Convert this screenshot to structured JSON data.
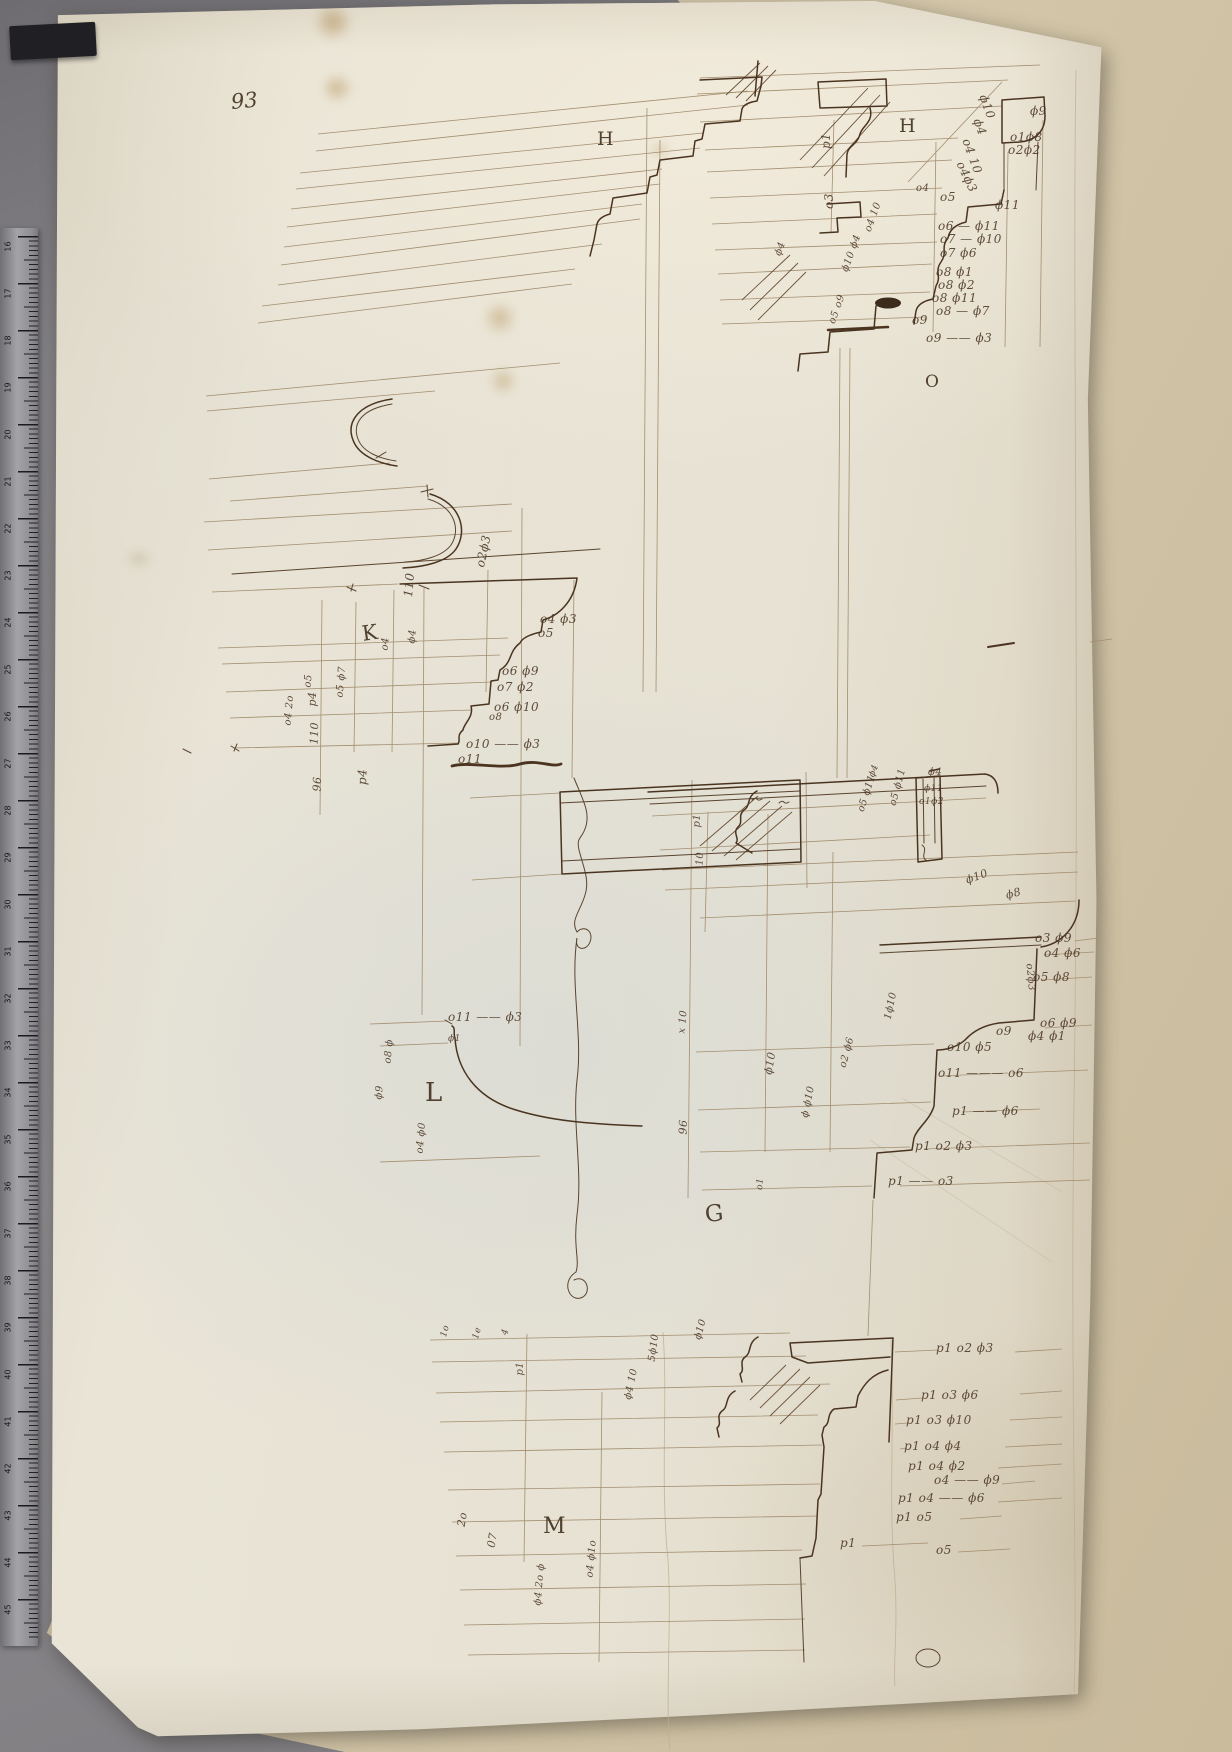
{
  "page": {
    "number": "93"
  },
  "colors": {
    "ink": "#4a3420",
    "ink_light": "#a38e6f",
    "paper": "#e8e3d6",
    "table": "#838185",
    "undersheet": "#d6c9ae",
    "ruler": "#95959a"
  },
  "labels": [
    {
      "text": "H",
      "x": 597,
      "y": 128,
      "s": 19,
      "r": 0
    },
    {
      "text": "H",
      "x": 899,
      "y": 115,
      "s": 19,
      "r": 0
    },
    {
      "text": "O",
      "x": 925,
      "y": 372,
      "s": 17,
      "r": 0
    },
    {
      "text": "K",
      "x": 362,
      "y": 622,
      "s": 21,
      "r": -8
    },
    {
      "text": "L",
      "x": 425,
      "y": 1078,
      "s": 26,
      "r": 0
    },
    {
      "text": "G",
      "x": 705,
      "y": 1202,
      "s": 23,
      "r": -6
    },
    {
      "text": "M",
      "x": 543,
      "y": 1514,
      "s": 22,
      "r": 0
    }
  ],
  "annotations": [
    {
      "text": "ϕ9",
      "x": 1030,
      "y": 104,
      "r": 0
    },
    {
      "text": "o1ϕ8",
      "x": 1010,
      "y": 130,
      "r": 0
    },
    {
      "text": "o2ϕ2",
      "x": 1008,
      "y": 143,
      "r": 0
    },
    {
      "text": "ϕ10",
      "x": 983,
      "y": 88,
      "r": 70
    },
    {
      "text": "ϕ4",
      "x": 977,
      "y": 112,
      "r": 70
    },
    {
      "text": "o4 10",
      "x": 966,
      "y": 132,
      "r": 70
    },
    {
      "text": "o4ϕ3",
      "x": 960,
      "y": 155,
      "r": 65
    },
    {
      "text": "o4",
      "x": 916,
      "y": 183,
      "r": 0,
      "s": 10
    },
    {
      "text": "o5",
      "x": 940,
      "y": 190,
      "r": 0
    },
    {
      "text": "ϕ11",
      "x": 995,
      "y": 198,
      "r": 0
    },
    {
      "text": "o6 — ϕ11",
      "x": 938,
      "y": 219,
      "r": 0
    },
    {
      "text": "o7 — ϕ10",
      "x": 940,
      "y": 232,
      "r": 0
    },
    {
      "text": "o7  ϕ6",
      "x": 940,
      "y": 246,
      "r": 0
    },
    {
      "text": "o8    ϕ1",
      "x": 936,
      "y": 265,
      "r": 0
    },
    {
      "text": "o8   ϕ2",
      "x": 938,
      "y": 278,
      "r": 0
    },
    {
      "text": "o8   ϕ11",
      "x": 932,
      "y": 291,
      "r": 0
    },
    {
      "text": "o8 — ϕ7",
      "x": 936,
      "y": 304,
      "r": 0
    },
    {
      "text": "o9",
      "x": 912,
      "y": 313,
      "r": 0
    },
    {
      "text": "o9 —— ϕ3",
      "x": 926,
      "y": 331,
      "r": 0
    },
    {
      "text": "p1",
      "x": 826,
      "y": 142,
      "r": -90
    },
    {
      "text": "o3",
      "x": 829,
      "y": 202,
      "r": -90
    },
    {
      "text": "ϕ4",
      "x": 778,
      "y": 250,
      "r": -70,
      "s": 10
    },
    {
      "text": "o4 10",
      "x": 868,
      "y": 226,
      "r": -70,
      "s": 10
    },
    {
      "text": "ϕ10 ϕ4",
      "x": 845,
      "y": 266,
      "r": -70,
      "s": 10
    },
    {
      "text": "o5 o9",
      "x": 832,
      "y": 318,
      "r": -70,
      "s": 10
    },
    {
      "text": "o2ϕ3",
      "x": 480,
      "y": 560,
      "r": -78
    },
    {
      "text": "o4 ϕ3",
      "x": 540,
      "y": 612,
      "r": 0
    },
    {
      "text": "o5",
      "x": 538,
      "y": 626,
      "r": 0
    },
    {
      "text": "o6 ϕ9",
      "x": 502,
      "y": 664,
      "r": 0
    },
    {
      "text": "o7 ϕ2",
      "x": 497,
      "y": 680,
      "r": 0
    },
    {
      "text": "o6  ϕ10",
      "x": 494,
      "y": 700,
      "r": 0
    },
    {
      "text": "o8",
      "x": 489,
      "y": 712,
      "r": 0,
      "s": 10
    },
    {
      "text": "o10 —— ϕ3",
      "x": 466,
      "y": 737,
      "r": 0
    },
    {
      "text": "o11",
      "x": 458,
      "y": 752,
      "r": 0
    },
    {
      "text": "110",
      "x": 408,
      "y": 590,
      "r": -85
    },
    {
      "text": "ϕ4",
      "x": 412,
      "y": 638,
      "r": -85,
      "s": 10
    },
    {
      "text": "o4",
      "x": 385,
      "y": 645,
      "r": -85,
      "s": 10
    },
    {
      "text": "o5",
      "x": 308,
      "y": 682,
      "r": -85,
      "s": 10
    },
    {
      "text": "o5 ϕ7",
      "x": 340,
      "y": 692,
      "r": -85,
      "s": 10
    },
    {
      "text": "o4 2o",
      "x": 288,
      "y": 720,
      "r": -85,
      "s": 10
    },
    {
      "text": "p4",
      "x": 362,
      "y": 778,
      "r": -88
    },
    {
      "text": "p4",
      "x": 312,
      "y": 700,
      "r": -88,
      "s": 11
    },
    {
      "text": "110",
      "x": 314,
      "y": 738,
      "r": -88,
      "s": 11
    },
    {
      "text": "96",
      "x": 317,
      "y": 785,
      "r": -88,
      "s": 11
    },
    {
      "text": "ϕ4",
      "x": 928,
      "y": 767,
      "r": 0,
      "s": 10
    },
    {
      "text": "ϕ11",
      "x": 924,
      "y": 784,
      "r": 0,
      "s": 9
    },
    {
      "text": "o1ϕ2",
      "x": 919,
      "y": 797,
      "r": 0,
      "s": 9
    },
    {
      "text": "o5 ϕ11",
      "x": 893,
      "y": 800,
      "r": -75,
      "s": 10
    },
    {
      "text": "o5 ϕ11",
      "x": 861,
      "y": 806,
      "r": -72,
      "s": 10
    },
    {
      "text": "ϕ4",
      "x": 872,
      "y": 772,
      "r": -70,
      "s": 9
    },
    {
      "text": "ϕ10",
      "x": 966,
      "y": 874,
      "r": -20,
      "s": 11
    },
    {
      "text": "ϕ8",
      "x": 1006,
      "y": 889,
      "r": -15,
      "s": 11
    },
    {
      "text": "o3 ϕ9",
      "x": 1035,
      "y": 931,
      "r": 0
    },
    {
      "text": "o4 ϕ6",
      "x": 1044,
      "y": 946,
      "r": 0
    },
    {
      "text": "o5 ϕ8",
      "x": 1033,
      "y": 970,
      "r": 0
    },
    {
      "text": "o2ϕ3",
      "x": 1029,
      "y": 958,
      "r": 85,
      "s": 10
    },
    {
      "text": "o6 ϕ9",
      "x": 1040,
      "y": 1016,
      "r": 0
    },
    {
      "text": "o9",
      "x": 996,
      "y": 1024,
      "r": 0
    },
    {
      "text": "ϕ4 ϕ1",
      "x": 1028,
      "y": 1029,
      "r": 0
    },
    {
      "text": "o10  ϕ5",
      "x": 947,
      "y": 1040,
      "r": 0
    },
    {
      "text": "o11 ——— o6",
      "x": 938,
      "y": 1066,
      "r": 0
    },
    {
      "text": "p1 —— ϕ6",
      "x": 952,
      "y": 1104,
      "r": 0
    },
    {
      "text": "p1 o2 ϕ3",
      "x": 915,
      "y": 1139,
      "r": 0
    },
    {
      "text": "p1 —— o3",
      "x": 888,
      "y": 1174,
      "r": 0
    },
    {
      "text": "1ϕ10",
      "x": 888,
      "y": 1014,
      "r": -78,
      "s": 10
    },
    {
      "text": "o2 ϕ6",
      "x": 843,
      "y": 1062,
      "r": -75,
      "s": 10
    },
    {
      "text": "ϕ10",
      "x": 768,
      "y": 1068,
      "r": -80,
      "s": 11
    },
    {
      "text": "ϕ ϕ10",
      "x": 805,
      "y": 1112,
      "r": -78,
      "s": 10
    },
    {
      "text": "p1",
      "x": 697,
      "y": 822,
      "r": -88,
      "s": 10
    },
    {
      "text": "10",
      "x": 700,
      "y": 860,
      "r": -88,
      "s": 10
    },
    {
      "text": "x 10",
      "x": 682,
      "y": 1028,
      "r": -85,
      "s": 10
    },
    {
      "text": "96",
      "x": 683,
      "y": 1128,
      "r": -88,
      "s": 11
    },
    {
      "text": "o1",
      "x": 760,
      "y": 1185,
      "r": -85,
      "s": 9
    },
    {
      "text": "o11 —— ϕ3",
      "x": 448,
      "y": 1010,
      "r": 0
    },
    {
      "text": "ϕ1",
      "x": 448,
      "y": 1034,
      "r": 0,
      "s": 9
    },
    {
      "text": "o8 ϕ",
      "x": 388,
      "y": 1058,
      "r": -85,
      "s": 10
    },
    {
      "text": "ϕ9",
      "x": 379,
      "y": 1094,
      "r": -85,
      "s": 10
    },
    {
      "text": "o4 ϕ0",
      "x": 420,
      "y": 1148,
      "r": -85,
      "s": 10
    },
    {
      "text": "p1 o2 ϕ3",
      "x": 936,
      "y": 1341,
      "r": 0
    },
    {
      "text": "p1  o3  ϕ6",
      "x": 921,
      "y": 1388,
      "r": 0
    },
    {
      "text": "p1  o3  ϕ10",
      "x": 906,
      "y": 1413,
      "r": 0
    },
    {
      "text": "p1  o4  ϕ4",
      "x": 904,
      "y": 1439,
      "r": 0
    },
    {
      "text": "p1 o4  ϕ2",
      "x": 908,
      "y": 1459,
      "r": 0
    },
    {
      "text": "o4 —— ϕ9",
      "x": 934,
      "y": 1473,
      "r": 0
    },
    {
      "text": "p1  o4 —— ϕ6",
      "x": 898,
      "y": 1491,
      "r": 0
    },
    {
      "text": "p1  o5",
      "x": 896,
      "y": 1510,
      "r": 0
    },
    {
      "text": "p1",
      "x": 840,
      "y": 1536,
      "r": 0
    },
    {
      "text": "o5",
      "x": 936,
      "y": 1543,
      "r": 0
    },
    {
      "text": "p1",
      "x": 520,
      "y": 1370,
      "r": -88,
      "s": 10
    },
    {
      "text": "ϕ4 10",
      "x": 628,
      "y": 1394,
      "r": -78,
      "s": 10
    },
    {
      "text": "5ϕ10",
      "x": 652,
      "y": 1356,
      "r": -82,
      "s": 10
    },
    {
      "text": "ϕ10",
      "x": 698,
      "y": 1334,
      "r": -75,
      "s": 10
    },
    {
      "text": "1o",
      "x": 444,
      "y": 1332,
      "r": -75,
      "s": 9
    },
    {
      "text": "1e",
      "x": 476,
      "y": 1334,
      "r": -75,
      "s": 9
    },
    {
      "text": "4",
      "x": 505,
      "y": 1330,
      "r": -75,
      "s": 9
    },
    {
      "text": "2o",
      "x": 461,
      "y": 1520,
      "r": -80,
      "s": 11
    },
    {
      "text": "07",
      "x": 491,
      "y": 1541,
      "r": -80,
      "s": 11
    },
    {
      "text": "ϕ4 2o ϕ",
      "x": 538,
      "y": 1600,
      "r": -85,
      "s": 10
    },
    {
      "text": "o4 ϕ1o",
      "x": 590,
      "y": 1572,
      "r": -85,
      "s": 10
    }
  ],
  "ruler": {
    "numbers": [
      "16",
      "17",
      "18",
      "19",
      "20",
      "21",
      "22",
      "23",
      "24",
      "25",
      "26",
      "27",
      "28",
      "29",
      "30",
      "31",
      "32",
      "33",
      "34",
      "35",
      "36",
      "37",
      "38",
      "39",
      "40",
      "41",
      "42",
      "43",
      "44",
      "45"
    ]
  }
}
